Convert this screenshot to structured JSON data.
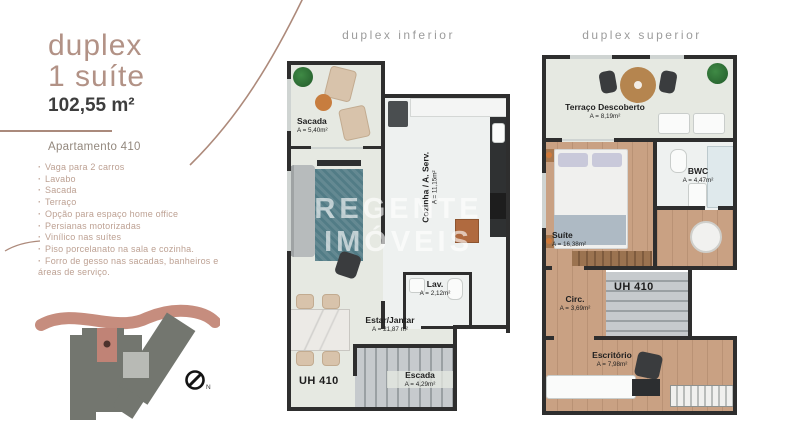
{
  "left_panel": {
    "title_line1": "duplex",
    "title_line2": "1 suíte",
    "area": "102,55 m²",
    "subtitle": "Apartamento 410",
    "bullet_glyph": "·",
    "features": [
      "Vaga para 2 carros",
      "Lavabo",
      "Sacada",
      "Terraço",
      "Opção para espaço home office",
      "Persianas motorizadas",
      "Vinílico nas suítes",
      "Piso porcelanato na sala e cozinha.",
      "Forro de gesso nas sacadas, banheiros e áreas de serviço."
    ],
    "siteplan": {
      "compass_label": "N"
    }
  },
  "plans": {
    "inferior": {
      "title": "duplex inferior",
      "unit_label": "UH 410",
      "rooms": {
        "sacada": {
          "name": "Sacada",
          "area": "A = 5,40m²"
        },
        "cozinha": {
          "name": "Cozinha / A. Serv.",
          "area": "A = 11,15m²"
        },
        "lav": {
          "name": "Lav.",
          "area": "A = 2,12m²"
        },
        "estar": {
          "name": "Estar/Jantar",
          "area": "A = 21,87 m²"
        },
        "escada": {
          "name": "Escada",
          "area": "A = 4,29m²"
        }
      }
    },
    "superior": {
      "title": "duplex superior",
      "unit_label": "UH 410",
      "rooms": {
        "terraco": {
          "name": "Terraço Descoberto",
          "area": "A = 8,19m²"
        },
        "suite": {
          "name": "Suíte",
          "area": "A = 16,38m²"
        },
        "bwc": {
          "name": "BWC",
          "area": "A = 4,47m²"
        },
        "circ": {
          "name": "Circ.",
          "area": "A = 3,69m²"
        },
        "escritorio": {
          "name": "Escritório",
          "area": "A = 7,98m²"
        }
      }
    },
    "watermark": {
      "line1": "REGENTE",
      "line2": "IMÓVEIS"
    }
  },
  "colors": {
    "accent_rose": "#b29286",
    "feature_text": "#bda193",
    "text_dark": "#3d3d3d",
    "plan_title_gray": "#9c9c9c",
    "wall": "#2e2e2e",
    "floor_light": "#e6e9e2",
    "floor_kitchen": "#eef1f0",
    "floor_wood": "#c9a183",
    "stairs_gray": "#c6cacd",
    "rug_teal": "#527c86",
    "site_building_gray": "#73766f",
    "site_unit_rose": "#c08376",
    "road_rose": "#c68d7e"
  }
}
